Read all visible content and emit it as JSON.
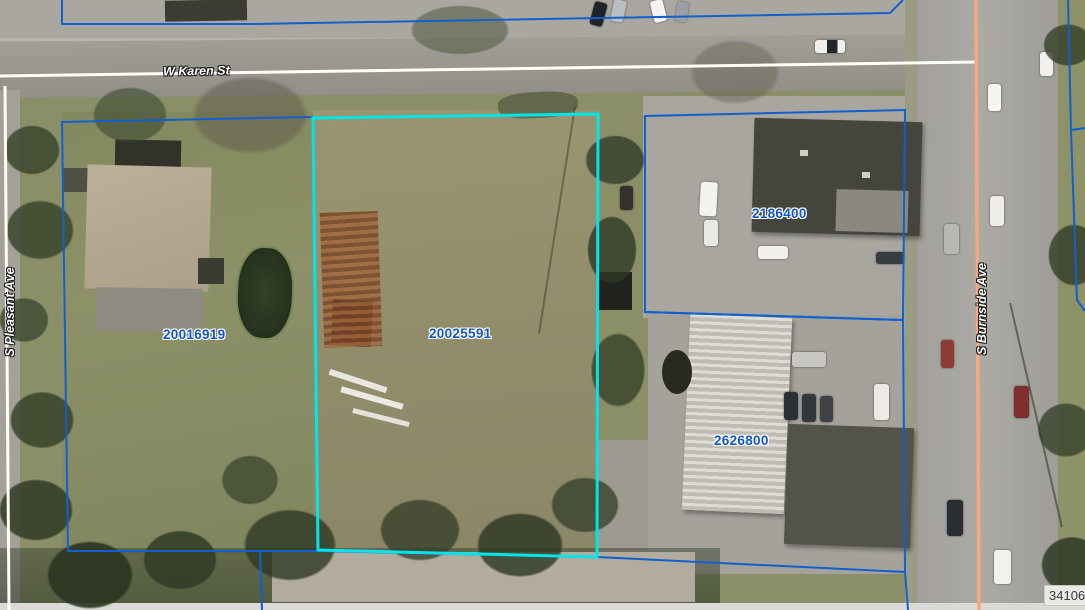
{
  "map": {
    "streets": {
      "karen": "W Karen St",
      "pleasant": "S Pleasant Ave",
      "burnside": "S Burnside Ave"
    },
    "parcels": [
      {
        "id": "20016919",
        "selected": false
      },
      {
        "id": "20025591",
        "selected": true
      },
      {
        "id": "2186400",
        "selected": false
      },
      {
        "id": "2626800",
        "selected": false
      }
    ],
    "corner_label": "341068",
    "colors": {
      "parcel_line": "#1160cf",
      "selected_parcel_line": "#00e4ec",
      "parcel_label_text": "#1355cc",
      "street_label_text": "#ffffff",
      "centerline_white": "#fffef5",
      "centerline_orange": "#f8a87e"
    }
  }
}
